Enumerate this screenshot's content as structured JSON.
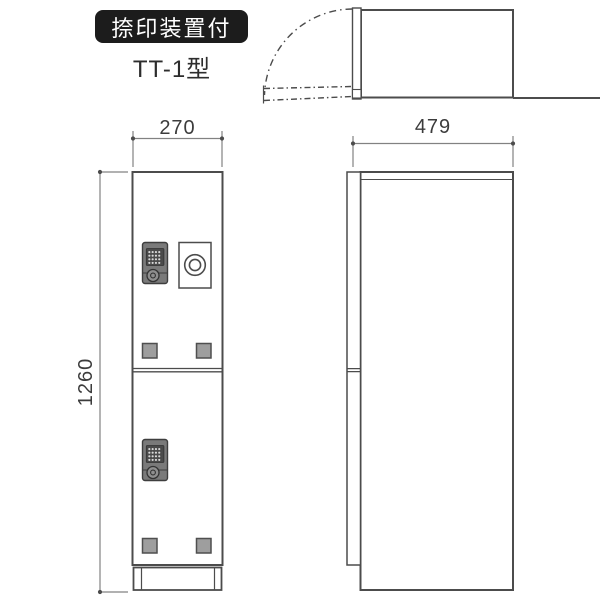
{
  "product": {
    "feature_badge": "捺印装置付",
    "model_name": "TT-1型"
  },
  "dimensions": {
    "front_width_mm": "270",
    "height_mm": "1260",
    "depth_mm": "479"
  },
  "colors": {
    "background": "#ffffff",
    "line": "#4c4c4c",
    "dim_line": "#828282",
    "dim_text": "#3c3c3c",
    "badge_bg": "#1c1c1c",
    "badge_text": "#ffffff",
    "lock_body": "#7a7a7a",
    "lock_panel": "#4a4a4a",
    "lock_dots": "#d8d8d8",
    "foot_fill": "#9e9e9e"
  }
}
